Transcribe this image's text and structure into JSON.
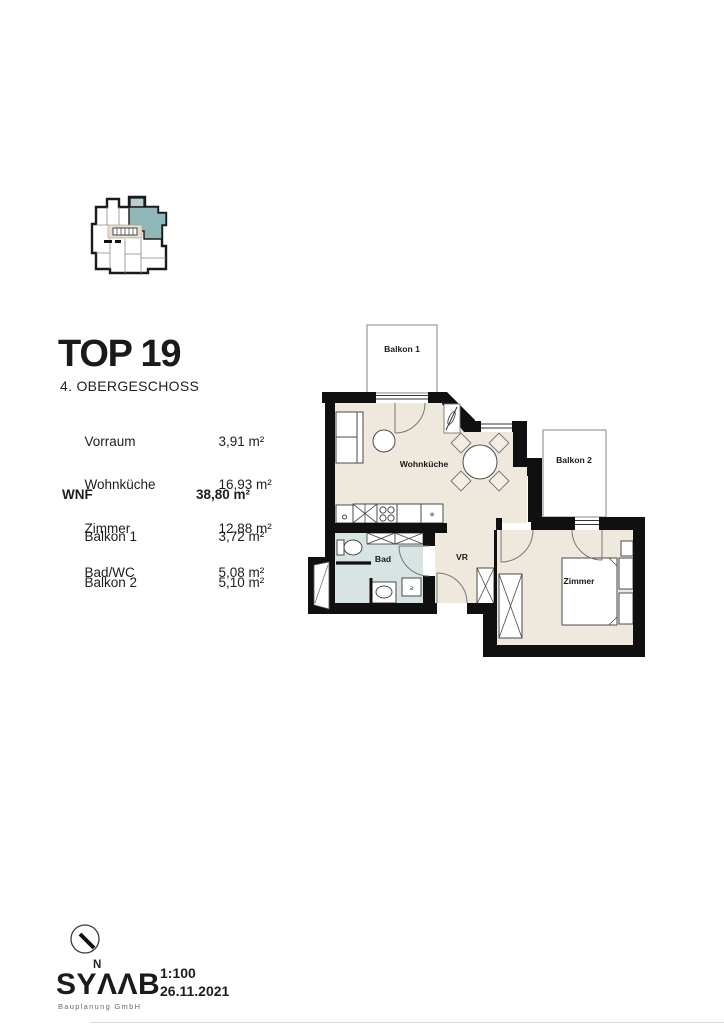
{
  "title": {
    "main": "TOP 19",
    "subtitle": "4. OBERGESCHOSS"
  },
  "area_table": {
    "rows": [
      {
        "label": "Vorraum",
        "value": "3,91 m²"
      },
      {
        "label": "Wohnküche",
        "value": "16,93 m²"
      },
      {
        "label": "Zimmer",
        "value": "12,88 m²"
      },
      {
        "label": "Bad/WC",
        "value": "5,08 m²"
      }
    ],
    "total": {
      "label": "WNF",
      "value": "38,80 m²"
    },
    "balcony_rows": [
      {
        "label": "Balkon 1",
        "value": "3,72 m²"
      },
      {
        "label": "Balkon 2",
        "value": "5,10 m²"
      }
    ]
  },
  "floor_plan": {
    "labels": {
      "balkon1": "Balkon 1",
      "balkon2": "Balkon 2",
      "wohnkueche": "Wohnküche",
      "bad": "Bad",
      "vr": "VR",
      "zimmer": "Zimmer"
    },
    "colors": {
      "wall": "#101010",
      "floor": "#efe9dd",
      "bath_floor": "#d8e4e3",
      "thin_line": "#555555",
      "balcony_border": "#9a9a9a"
    }
  },
  "overview_plan": {
    "colors": {
      "highlight": "#8fb7b7",
      "highlight_light": "#b9cfcf",
      "stair": "#eadfc6"
    }
  },
  "footer": {
    "north": "N",
    "logo": "SYΛΛB",
    "logo_sub": "Bauplanung GmbH",
    "scale": "1:100",
    "date": "26.11.2021"
  }
}
